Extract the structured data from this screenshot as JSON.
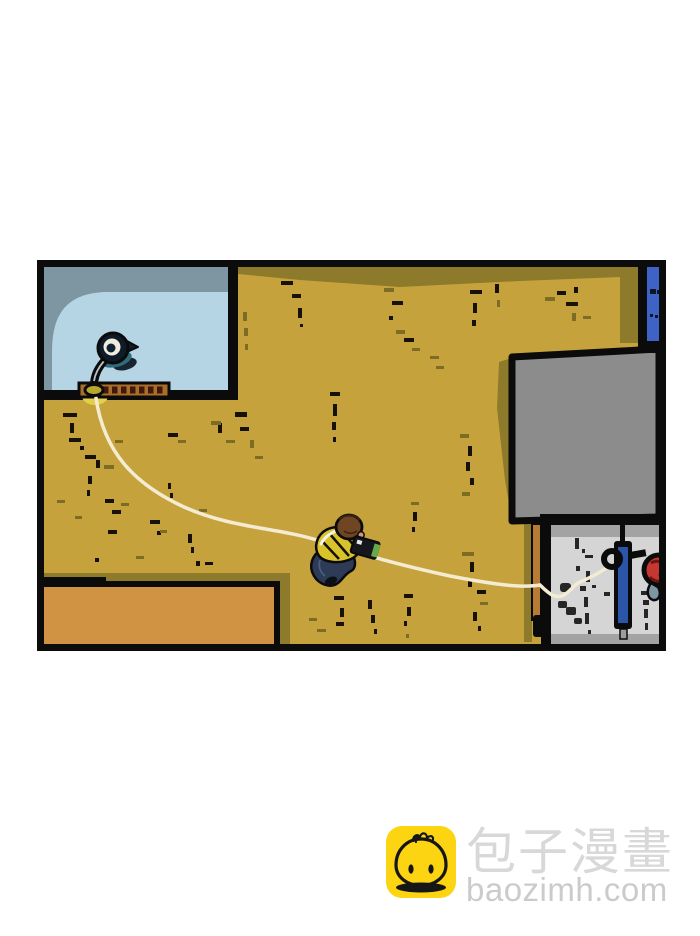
{
  "comic_panel": {
    "colors": {
      "floor": "#c6a23c",
      "floor_shadow": "#8d7a2a",
      "wall": "#0b0b0b",
      "rug_light": "#b5d4e4",
      "rug_dark": "#7e96a2",
      "sill": "#a76f2a",
      "sill_tick": "#43180b",
      "door": "#3d63c6",
      "tv": "#8c8c8c",
      "desk": "#d5d5d5",
      "desk_band": "#a3a3a3",
      "desk_brown": "#b87b33",
      "pole": "#2a55a8",
      "red_object": "#c63732",
      "teardrop": "#7e96a2",
      "cable": "#f4ecd2",
      "table": "#d09243",
      "shirt": "#d9c32b",
      "pants": "#2d3b57",
      "hair": "#6f4523",
      "camera_screen": "#67a848",
      "lamp_shade": "#2e6b7d",
      "lamp_glow": "#e4cf49",
      "dash_dark": "#171107",
      "dash_olive": "#7c6c24",
      "desk_mark": "#262626"
    }
  },
  "watermark": {
    "icon": "baozi-bun-icon",
    "brand_cn": "包子漫畫",
    "brand_domain": "baozimh.com",
    "icon_bg": "#fcd411",
    "text_color": "#d8d8d8",
    "domain_color": "#cbcbcb"
  }
}
